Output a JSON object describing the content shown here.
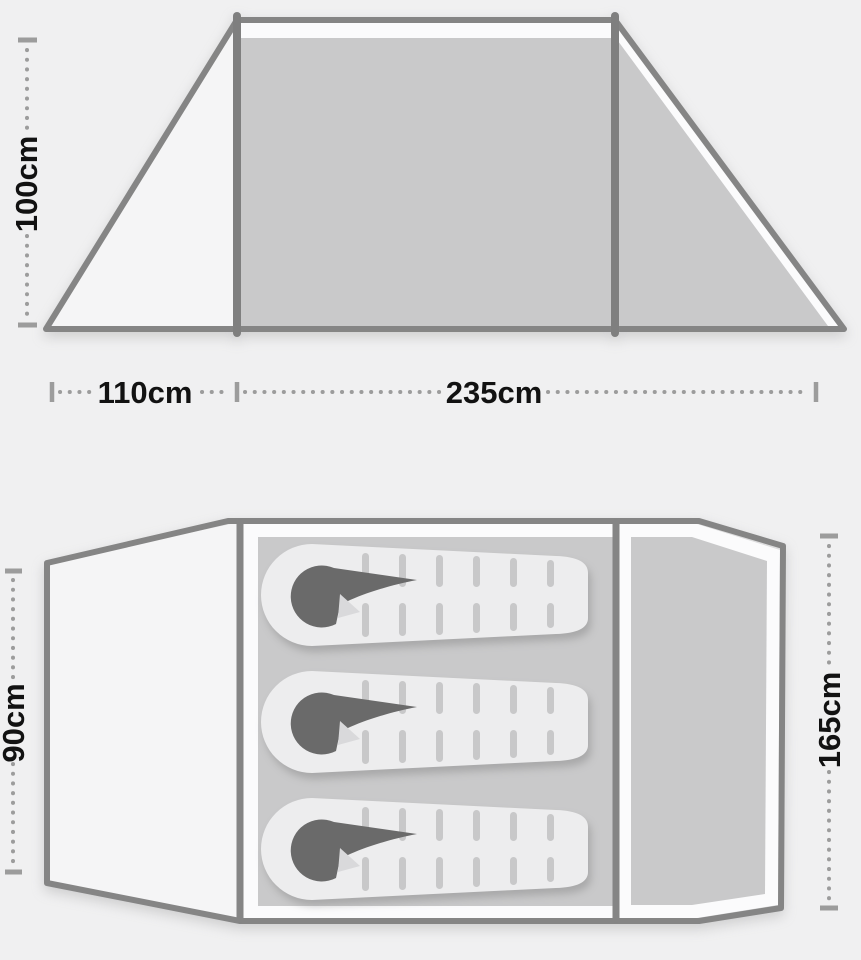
{
  "side_view": {
    "height_label": "100cm",
    "porch_width_label": "110cm",
    "body_width_label": "235cm"
  },
  "floor_plan": {
    "porch_depth_label": "90cm",
    "inner_length_label": "165cm",
    "sleeping_bag_count": 3
  },
  "colors": {
    "background": "#f0f0f1",
    "tent_outline": "#858585",
    "panel_gray": "#c9c9ca",
    "panel_white": "#fbfbfc",
    "porch_fill": "#f5f5f6",
    "dimension_gray": "#9c9c9c",
    "label_text": "#121212",
    "sleeping_bag_body": "#ededee",
    "sleeping_bag_stripe": "#c8c8c9",
    "sleeping_bag_hood": "#6a6a6a"
  }
}
